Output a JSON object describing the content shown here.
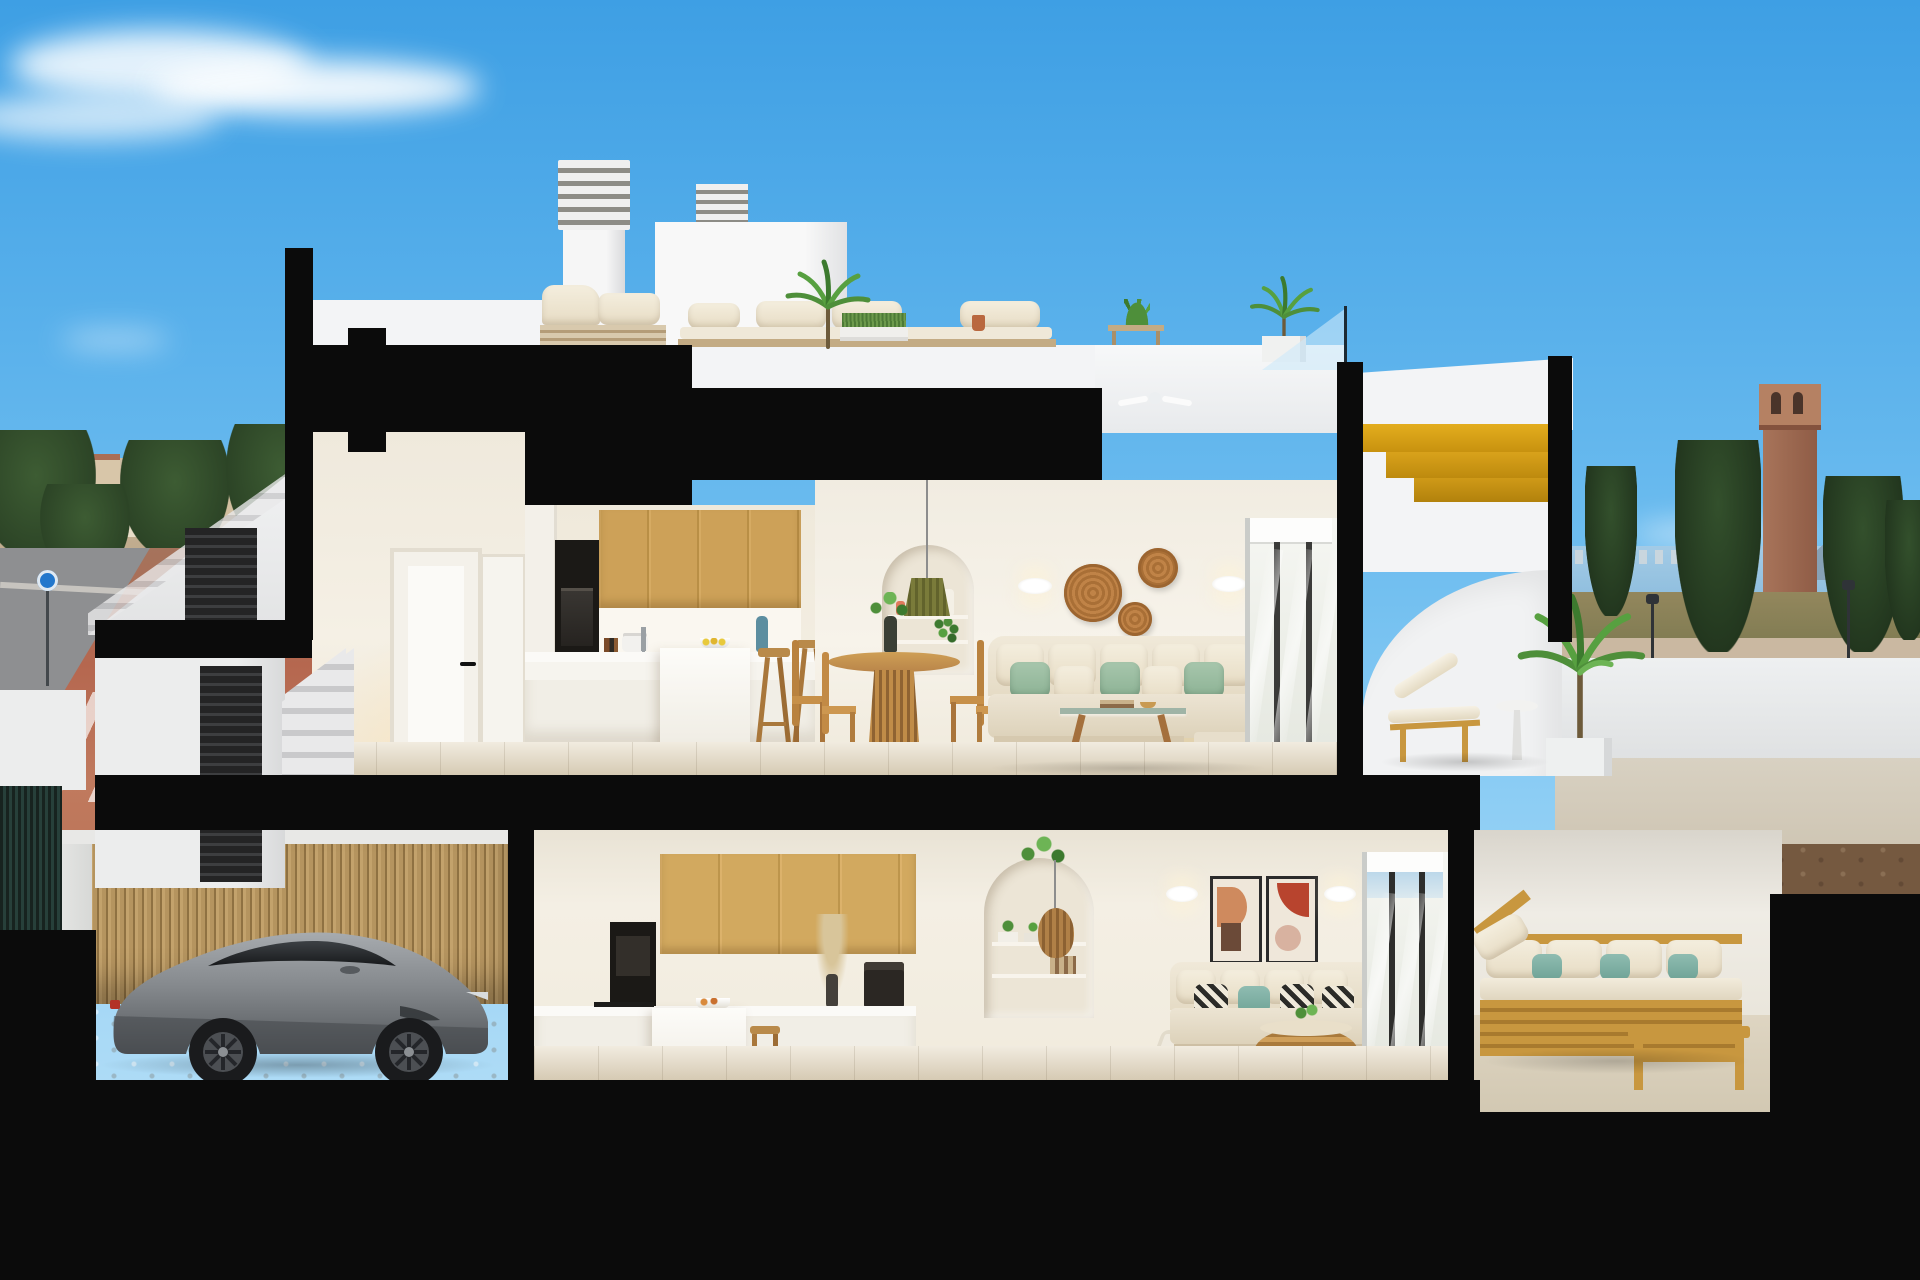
{
  "scene": {
    "type": "architectural cutaway render",
    "setting": "dusk, coastal town",
    "description": "Dollhouse cross-section of a two-storey white townhouse: roof terrace with lounge furniture and chimneys, upper open-plan apartment (kitchen, dining, living, sea-view terrace with sun lounger and curved parapet), lower apartment (kitchen, dining, living, timber-furnished terrace) and a street-level garage holding a silver sports coupe. Thick black lines mark the section cuts.",
    "palette": {
      "sky_top": "#3e9fe4",
      "sky_low": "#a8d9f6",
      "cloud": "#ffffff",
      "section_cut": "#0b0b0b",
      "exterior_wall": "#f3f4f6",
      "interior_wall": "#f3eee3",
      "oak_cabinet": "#d2a75e",
      "floor_tile": "#e8dfcb",
      "stair_gold": "#d9a21b",
      "sofa_cream": "#ece4d3",
      "cushion_sage": "#9dbfa4",
      "rattan": "#c08347",
      "street_paving": "#b5674f",
      "sea": "#a3cbe6",
      "palm_green": "#4e8f3a",
      "car_body": "#8b8f93",
      "timber_slats": "#b3925f",
      "gate_dark": "#26262a"
    },
    "labels": {
      "scene": "cutaway render of two-storey coastal townhouse at dusk",
      "sky": "dusk blue sky with wispy clouds",
      "bg_left": "town skyline, pine trees and red paved street with crosswalk",
      "bg_right": "sea horizon, distant skyline, brick watchtower, cypress trees, street lamps",
      "roof_terrace": "roof terrace with white lounge set, potted palms and louvred chimneys",
      "stair": "sculptural staircase with golden timber steps and glass balustrade",
      "upper_floor": "upper apartment: oak kitchen, round dining table, cream sofa with sage cushions, arched shelf niche, rattan wall discs",
      "upper_terrace": "upper terrace with timber sun lounger behind curved white parapet",
      "lower_floor": "lower apartment: oak kitchen, glass dining table, cream sofa with patterned cushions, two abstract artworks",
      "lower_terrace": "lower terrace with timber outdoor sofa, white and teal cushions",
      "garage": "garage with timber slat wall and cobble floor",
      "car": "silver grey sports coupe parked in garage",
      "entrance": "street entrance: white wall, dark louvred gate and concrete steps"
    },
    "inventory": {
      "roof": [
        "louvred chimney",
        "second chimney",
        "stair bulkhead",
        "white lounge chairs",
        "white outdoor sofa",
        "grass planter",
        "potted palms",
        "aloe pot",
        "ceiling fan",
        "glass balustrade"
      ],
      "upper_floor": [
        "white hall doors",
        "black oven column",
        "oak upper cabinets",
        "white island",
        "two wooden stools",
        "round slatted dining table",
        "four wooden chairs",
        "olive pendant lamp",
        "arched niche with coral vases and trailing plant",
        "three rattan discs",
        "two wall sconces",
        "cream corner sofa",
        "glass coffee table",
        "striped rug",
        "sliding glass door"
      ],
      "lower_floor": [
        "oak cabinets",
        "oven column",
        "coffee machine",
        "pampas vase",
        "island with stool",
        "arched niche with rattan pendant",
        "two abstract artworks",
        "two sconces",
        "cream sofa with patterned cushions",
        "round rattan coffee table",
        "white rug",
        "sliding glass door"
      ],
      "lower_terrace": [
        "timber sofa with white cushions",
        "teal pillows",
        "timber chaise",
        "timber coffee bench"
      ],
      "garage": [
        "silver sports coupe",
        "timber slat wall",
        "cobblestone floor"
      ]
    }
  }
}
